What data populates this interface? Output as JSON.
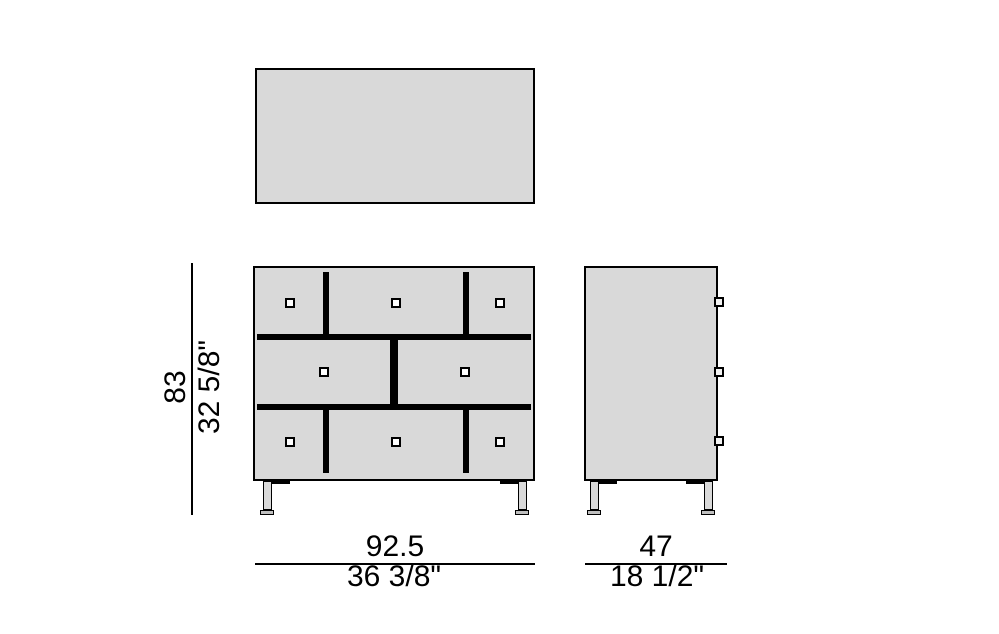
{
  "drawing": {
    "colors": {
      "background": "#ffffff",
      "surface": "#d9d9d9",
      "outline": "#000000",
      "knob_fill": "#ffffff"
    },
    "dimensions": {
      "height": {
        "cm": "83",
        "inches": "32 5/8\""
      },
      "width": {
        "cm": "92.5",
        "inches": "36 3/8\""
      },
      "depth": {
        "cm": "47",
        "inches": "18 1/2\""
      }
    }
  }
}
